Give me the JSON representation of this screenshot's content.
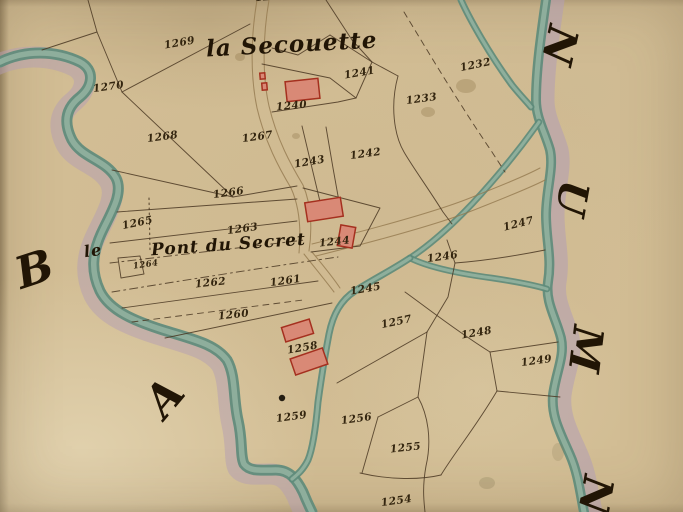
{
  "map": {
    "colors": {
      "paper": "#d2bd94",
      "ink": "#33250f",
      "ink_dark": "#211505",
      "boundary": "#4a3722",
      "road": "#93794f",
      "water_dark": "#5e8b7b",
      "water_light": "#98b7a4",
      "shadow": "#b39eb4",
      "building_fill": "#d98976",
      "building_stroke": "#a5301f"
    },
    "place_labels": [
      {
        "name": "label-la-secouette",
        "text": "la Secouette",
        "x": 206,
        "y": 33,
        "size": 23,
        "rot": -3
      },
      {
        "name": "label-pont-du-secret",
        "text": "Pont du Secret",
        "x": 151,
        "y": 237,
        "size": 17,
        "rot": -4
      },
      {
        "name": "label-le",
        "text": "le",
        "x": 84,
        "y": 243,
        "size": 16,
        "rot": -8
      }
    ],
    "region_letters": [
      {
        "name": "margin-letter-b",
        "text": "B",
        "x": 16,
        "y": 248,
        "size": 44,
        "rot": -18
      },
      {
        "name": "margin-letter-a",
        "text": "A",
        "x": 148,
        "y": 376,
        "size": 44,
        "rot": -50
      },
      {
        "name": "margin-letter-n-top",
        "text": "N",
        "x": 540,
        "y": 24,
        "size": 42,
        "rot": 103
      },
      {
        "name": "margin-letter-u",
        "text": "U",
        "x": 554,
        "y": 178,
        "size": 40,
        "rot": 100
      },
      {
        "name": "margin-letter-m",
        "text": "M",
        "x": 562,
        "y": 328,
        "size": 42,
        "rot": 97
      },
      {
        "name": "margin-letter-n-bottom",
        "text": "N",
        "x": 576,
        "y": 474,
        "size": 42,
        "rot": 100
      }
    ],
    "parcel_numbers": [
      {
        "text": "1239",
        "x": 255,
        "y": -8,
        "rot": -4
      },
      {
        "text": "1269",
        "x": 164,
        "y": 38,
        "rot": -10
      },
      {
        "text": "1270",
        "x": 93,
        "y": 82,
        "rot": -8
      },
      {
        "text": "1268",
        "x": 147,
        "y": 132,
        "rot": -8
      },
      {
        "text": "1267",
        "x": 242,
        "y": 132,
        "rot": -8
      },
      {
        "text": "1240",
        "x": 276,
        "y": 101,
        "rot": -5
      },
      {
        "text": "1241",
        "x": 344,
        "y": 68,
        "rot": -10
      },
      {
        "text": "1232",
        "x": 460,
        "y": 60,
        "rot": -12
      },
      {
        "text": "1233",
        "x": 406,
        "y": 94,
        "rot": -8
      },
      {
        "text": "1243",
        "x": 294,
        "y": 157,
        "rot": -10
      },
      {
        "text": "1242",
        "x": 350,
        "y": 149,
        "rot": -8
      },
      {
        "text": "1266",
        "x": 213,
        "y": 188,
        "rot": -8
      },
      {
        "text": "1265",
        "x": 122,
        "y": 218,
        "rot": -12
      },
      {
        "text": "1263",
        "x": 227,
        "y": 224,
        "rot": -8
      },
      {
        "text": "1264",
        "x": 133,
        "y": 261,
        "rot": -8,
        "size": 8.5
      },
      {
        "text": "1262",
        "x": 195,
        "y": 278,
        "rot": -6
      },
      {
        "text": "1261",
        "x": 270,
        "y": 276,
        "rot": -8
      },
      {
        "text": "1260",
        "x": 218,
        "y": 310,
        "rot": -6
      },
      {
        "text": "1244",
        "x": 319,
        "y": 237,
        "rot": -6
      },
      {
        "text": "1245",
        "x": 350,
        "y": 284,
        "rot": -10
      },
      {
        "text": "1246",
        "x": 427,
        "y": 252,
        "rot": -8
      },
      {
        "text": "1247",
        "x": 503,
        "y": 219,
        "rot": -14
      },
      {
        "text": "1257",
        "x": 381,
        "y": 317,
        "rot": -12
      },
      {
        "text": "1248",
        "x": 461,
        "y": 328,
        "rot": -10
      },
      {
        "text": "1249",
        "x": 521,
        "y": 356,
        "rot": -8
      },
      {
        "text": "1258",
        "x": 287,
        "y": 343,
        "rot": -10
      },
      {
        "text": "1259",
        "x": 276,
        "y": 412,
        "rot": -8
      },
      {
        "text": "1256",
        "x": 341,
        "y": 414,
        "rot": -8
      },
      {
        "text": "1255",
        "x": 390,
        "y": 443,
        "rot": -6
      },
      {
        "text": "1254",
        "x": 381,
        "y": 496,
        "rot": -8
      }
    ],
    "buildings": [
      {
        "x": 286,
        "y": 80,
        "w": 33,
        "h": 20,
        "rot": -6
      },
      {
        "x": 260,
        "y": 73,
        "w": 5,
        "h": 6,
        "rot": -5
      },
      {
        "x": 262,
        "y": 83,
        "w": 5,
        "h": 7,
        "rot": -5
      },
      {
        "x": 306,
        "y": 200,
        "w": 36,
        "h": 19,
        "rot": -9
      },
      {
        "x": 339,
        "y": 226,
        "w": 15,
        "h": 21,
        "rot": 10
      },
      {
        "x": 283,
        "y": 323,
        "w": 29,
        "h": 15,
        "rot": -17
      },
      {
        "x": 292,
        "y": 353,
        "w": 34,
        "h": 17,
        "rot": -19
      }
    ],
    "dots": [
      {
        "x": 282,
        "y": 398,
        "r": 3.2
      }
    ]
  }
}
